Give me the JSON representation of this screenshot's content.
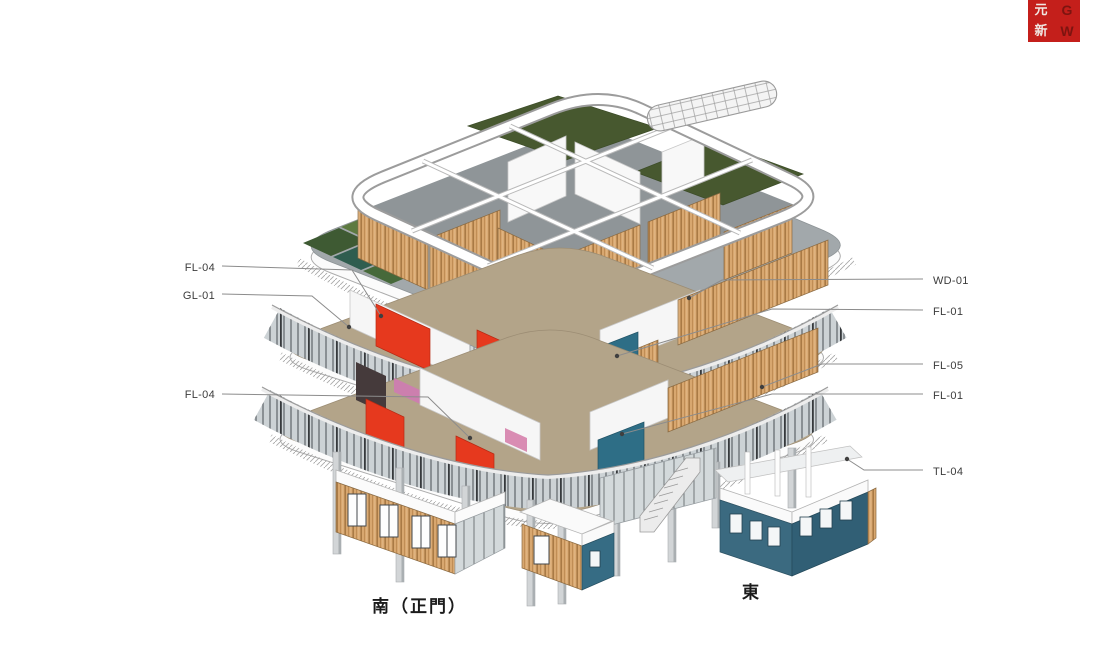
{
  "logo": {
    "background": "#c41f1b",
    "grid": {
      "r0c0": "元",
      "r0c1": "G",
      "r1c0": "新",
      "r1c1": "W"
    }
  },
  "callouts": {
    "left": [
      {
        "label": "FL-04"
      },
      {
        "label": "GL-01"
      },
      {
        "label": "FL-04"
      }
    ],
    "right": [
      {
        "label": "WD-01"
      },
      {
        "label": "FL-01"
      },
      {
        "label": "FL-05"
      },
      {
        "label": "FL-01"
      },
      {
        "label": "TL-04"
      }
    ]
  },
  "directions": {
    "south_main_gate": "南（正門）",
    "east": "東"
  },
  "palette": {
    "red_panel": "#e6391e",
    "teal_volume": "#3b6a80",
    "teal_panel": "#2e6e86",
    "wood_cladding": "#d8a76f",
    "green_roof": "#47582f",
    "deck_gray": "#90969a",
    "floor_tan": "#b3a489",
    "slab_white": "#fcfcfc",
    "leader_line": "#8c8c8c",
    "logo_red": "#c41f1b"
  }
}
